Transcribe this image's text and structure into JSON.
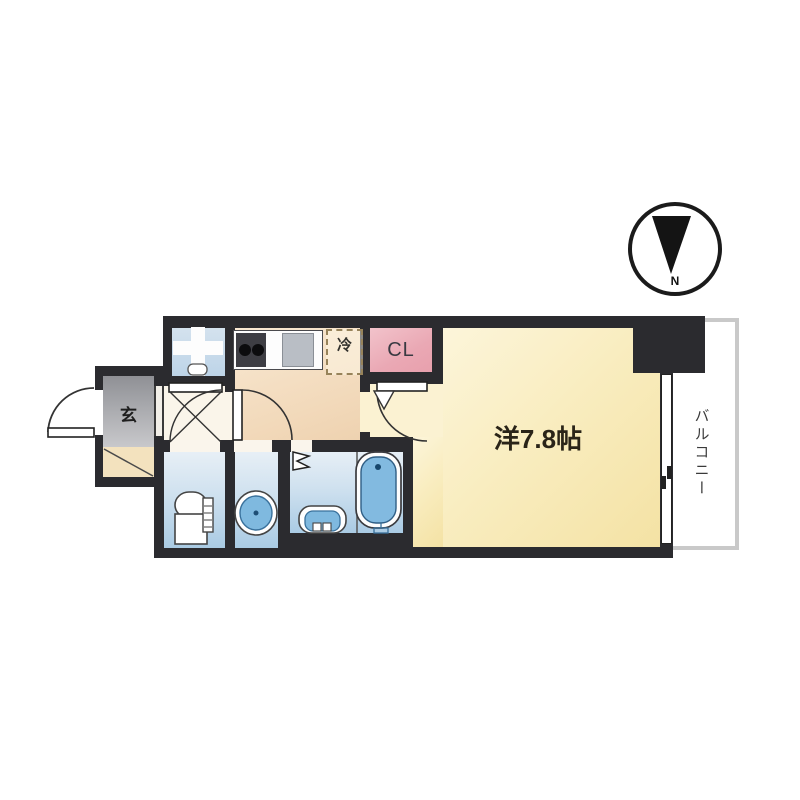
{
  "compass": {
    "north_label": "N"
  },
  "rooms": {
    "main_room": {
      "label": "洋7.8帖"
    },
    "closet": {
      "label": "CL"
    },
    "refrigerator": {
      "label": "冷"
    },
    "entrance": {
      "label": "玄"
    },
    "balcony": {
      "label": "バルコニー"
    }
  },
  "colors": {
    "wall": "#2b2b2f",
    "main_room_cream": "#f7e8b3",
    "kitchen_peach": "#f2d9bc",
    "closet_pink": "#eaa8b4",
    "entrance_gray": "#a9aaae",
    "wet_area_blue": "#cfe1ef",
    "fixture_blue": "#7fb9df",
    "balcony_border": "#c9c9c9"
  }
}
